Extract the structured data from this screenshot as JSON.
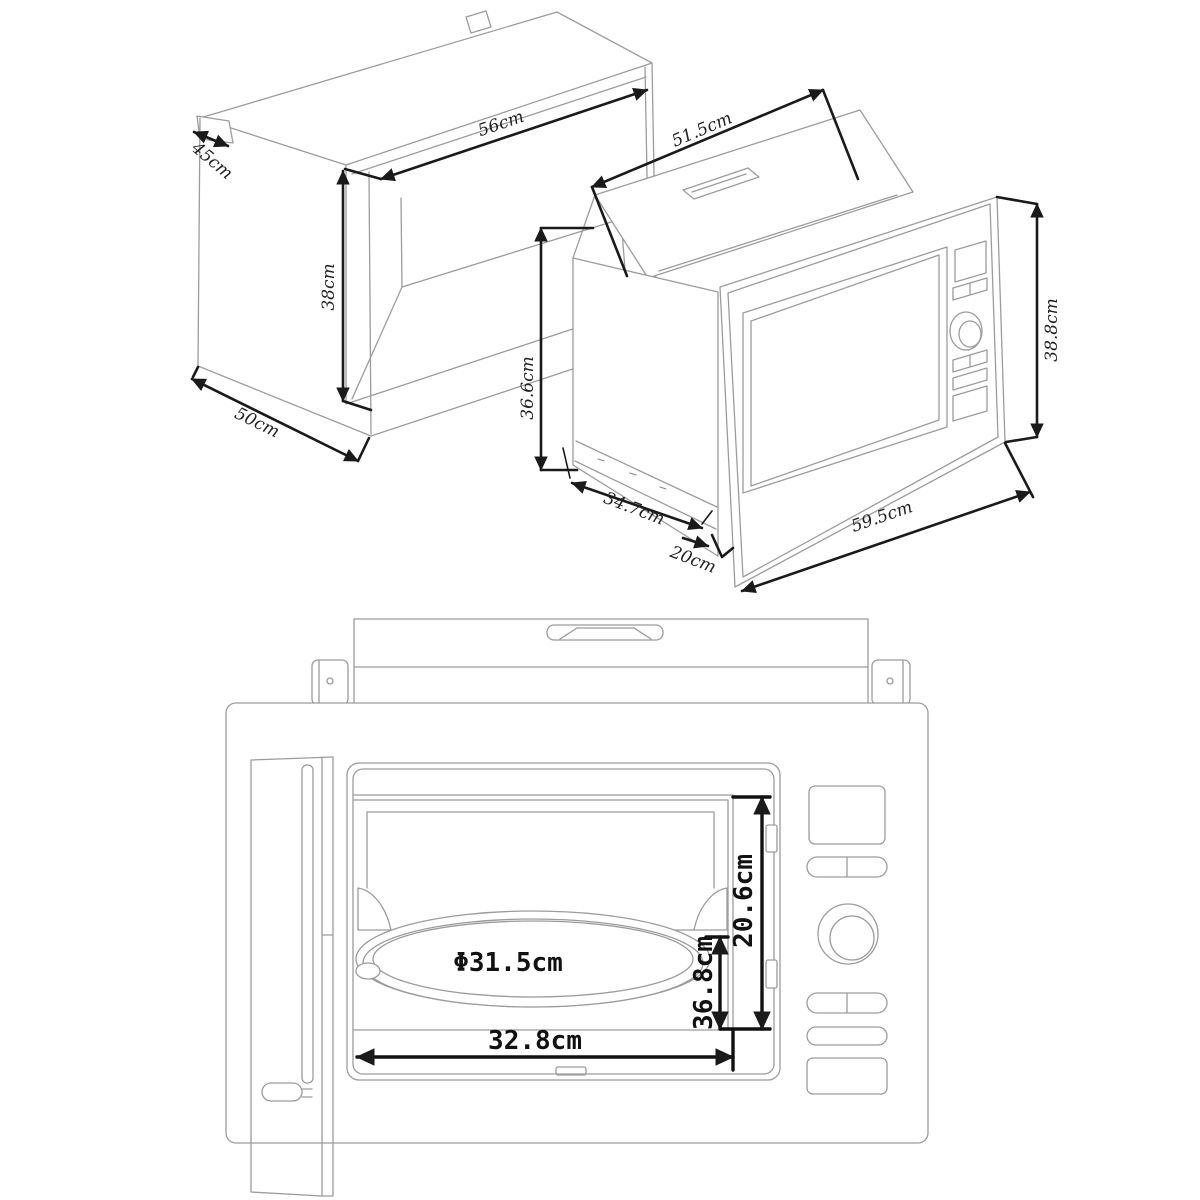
{
  "page": {
    "description": "Built-in microwave oven installation technical drawing with cabinet niche, isometric microwave view and front view",
    "background": "#ffffff"
  },
  "colors": {
    "outline": "#9c9c9c",
    "dimension_line": "#1a1a1a",
    "label_iso": "#222222",
    "label_front": "#111111"
  },
  "views": {
    "cabinet_niche": {
      "name": "cabinet-niche-isometric",
      "dims": {
        "depth_top": "45cm",
        "width": "56cm",
        "height": "38cm",
        "depth_bottom": "50cm"
      }
    },
    "microwave_isometric": {
      "name": "microwave-isometric",
      "dims": {
        "top_width": "51.5cm",
        "left_height": "36.6cm",
        "base_depth": "34.7cm",
        "rear_step": "20cm",
        "frame_width": "59.5cm",
        "frame_height": "38.8cm"
      }
    },
    "microwave_front": {
      "name": "microwave-front-view",
      "dims": {
        "turntable_diameter": "Φ31.5cm",
        "opening_height": "20.6cm",
        "inner_height": "36.8cm",
        "opening_width": "32.8cm"
      }
    }
  }
}
